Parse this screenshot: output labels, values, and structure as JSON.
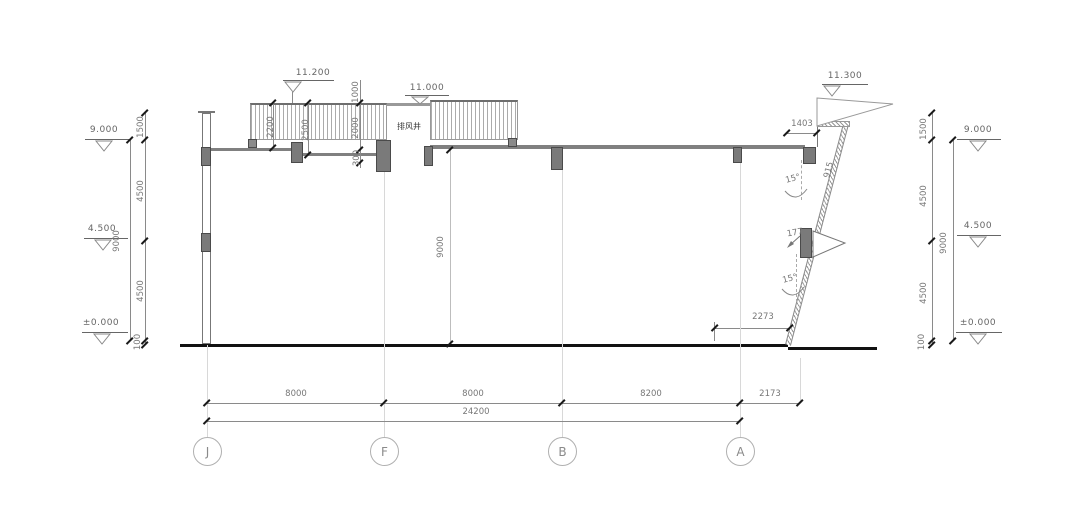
{
  "levels": {
    "top": [
      "11.200",
      "11.000",
      "11.300"
    ],
    "left": [
      "9.000",
      "4.500",
      "±0.000"
    ],
    "right": [
      "9.000",
      "4.500",
      "±0.000"
    ]
  },
  "dims": {
    "left_chain": [
      "1500",
      "4500",
      "4500",
      "100"
    ],
    "left_overall": "9000",
    "right_chain": [
      "1500",
      "4500",
      "4500",
      "100"
    ],
    "right_overall": "9000",
    "interior_height": "9000",
    "parapet": {
      "left_height": "2200",
      "mid_height": "2500",
      "shaft_top": "1000",
      "shaft_height": "2000",
      "beam_depth": "300"
    },
    "right_side": {
      "parapet_offset": "1403",
      "slope_segment": "915",
      "slope_angle_top": "15°",
      "canopy_offset": "177",
      "slope_angle_bottom": "15°",
      "base_offset": "2273"
    },
    "bottom": {
      "segments": [
        "8000",
        "8000",
        "8200",
        "2173"
      ],
      "overall": "24200"
    }
  },
  "grid": {
    "bubbles": [
      "J",
      "F",
      "B",
      "A"
    ]
  },
  "labels": {
    "exhaust_shaft": "排风井"
  }
}
